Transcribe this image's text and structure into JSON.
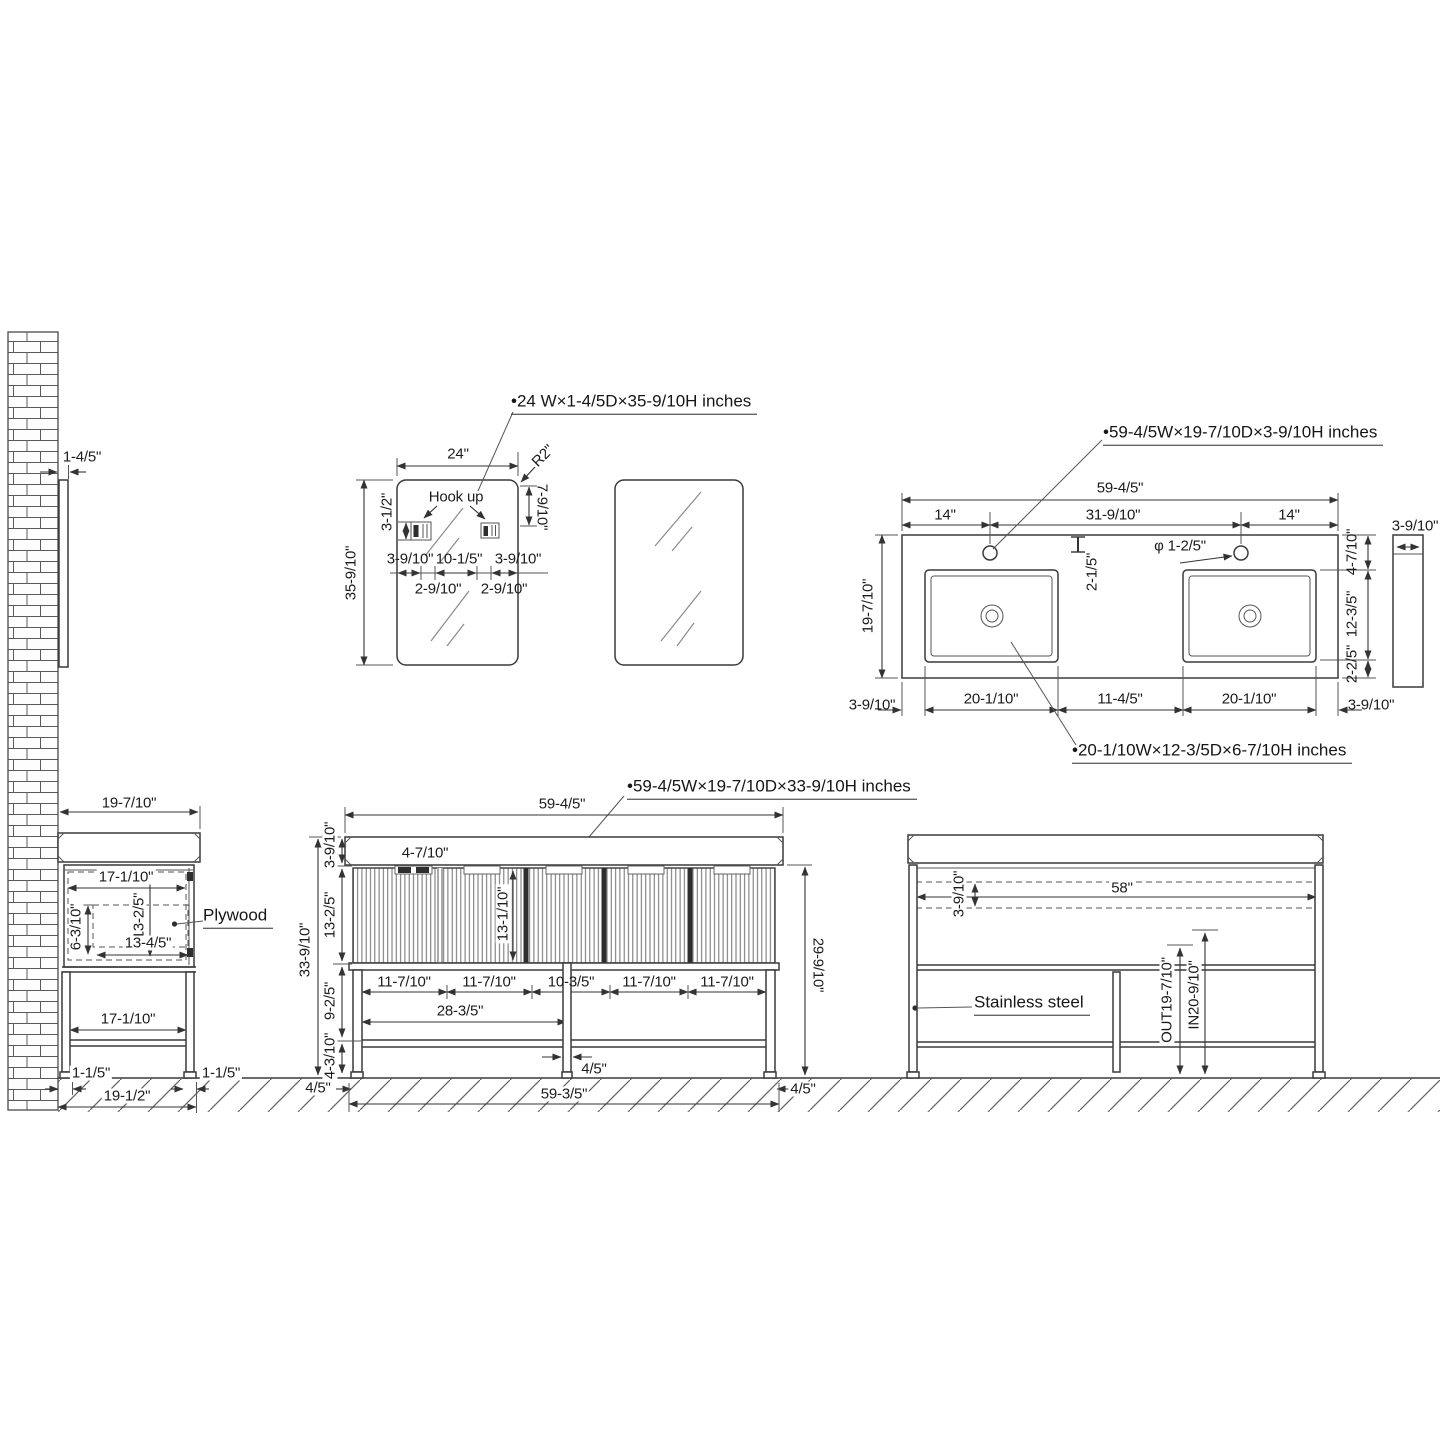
{
  "page": {
    "background": "#ffffff",
    "line_color": "#3a3a3a",
    "text_color": "#1c1c1c",
    "drawing_type": "bathroom vanity technical dimension drawing"
  },
  "mirror_view": {
    "callout": "•24 W×1-4/5D×35-9/10H  inches",
    "width": "24\"",
    "height": "35-9/10\"",
    "corner_radius": "R2\"",
    "hook_top_offset": "7-9/10\"",
    "hook_height": "3-1/2\"",
    "hook_label": "Hook up",
    "hook_left_offset": "3-9/10\"",
    "hook_spacing": "10-1/5\"",
    "hook_right_offset": "3-9/10\"",
    "hook_inner_left": "2-9/10\"",
    "hook_inner_right": "2-9/10\"",
    "wall_gap": "1-4/5\""
  },
  "countertop_view": {
    "callout": "•59-4/5W×19-7/10D×3-9/10H  inches",
    "sink_callout": "•20-1/10W×12-3/5D×6-7/10H  inches",
    "width": "59-4/5\"",
    "hole_left": "14\"",
    "hole_spacing": "31-9/10\"",
    "hole_right": "14\"",
    "hole_setback": "2-1/5\"",
    "hole_diameter": "φ 1-2/5\"",
    "depth": "19-7/10\"",
    "back_edge": "4-7/10\"",
    "sink_depth": "12-3/5\"",
    "front_edge": "2-2/5\"",
    "thickness": "3-9/10\"",
    "bottom_left_edge": "3-9/10\"",
    "sink_left_width": "20-1/10\"",
    "sink_gap": "11-4/5\"",
    "sink_right_width": "20-1/10\"",
    "bottom_right_edge": "3-9/10\""
  },
  "side_view": {
    "depth": "19-7/10\"",
    "opening_width": "17-1/10\"",
    "opening_height": "13-2/5\"",
    "cutout_height": "6-3/10\"",
    "cutout_width": "13-4/5\"",
    "plywood_label": "Plywood",
    "shelf_width": "17-1/10\"",
    "front_leg": "1-1/5\"",
    "back_leg": "1-1/5\"",
    "floor_depth": "19-1/2\""
  },
  "front_view": {
    "callout": "•59-4/5W×19-7/10D×33-9/10H  inches",
    "width": "59-4/5\"",
    "handle": "4-7/10\"",
    "door_inner_height": "13-1/10\"",
    "total_height": "33-9/10\"",
    "top_thickness": "3-9/10\"",
    "door_height": "13-2/5\"",
    "open_height": "9-2/5\"",
    "leg_height": "4-3/10\"",
    "panels": [
      "11-7/10\"",
      "11-7/10\"",
      "10-3/5\"",
      "11-7/10\"",
      "11-7/10\""
    ],
    "half_width": "28-3/5\"",
    "center_leg_width": "4/5\"",
    "left_leg_width": "4/5\"",
    "right_leg_width": "4/5\"",
    "base_width": "59-3/5\"",
    "frame_height": "29-9/10\""
  },
  "back_view": {
    "inner_width": "58\"",
    "backsplash_height": "3-9/10\"",
    "material_label": "Stainless steel",
    "out_height": "OUT19-7/10\"",
    "in_height": "IN20-9/10\""
  }
}
